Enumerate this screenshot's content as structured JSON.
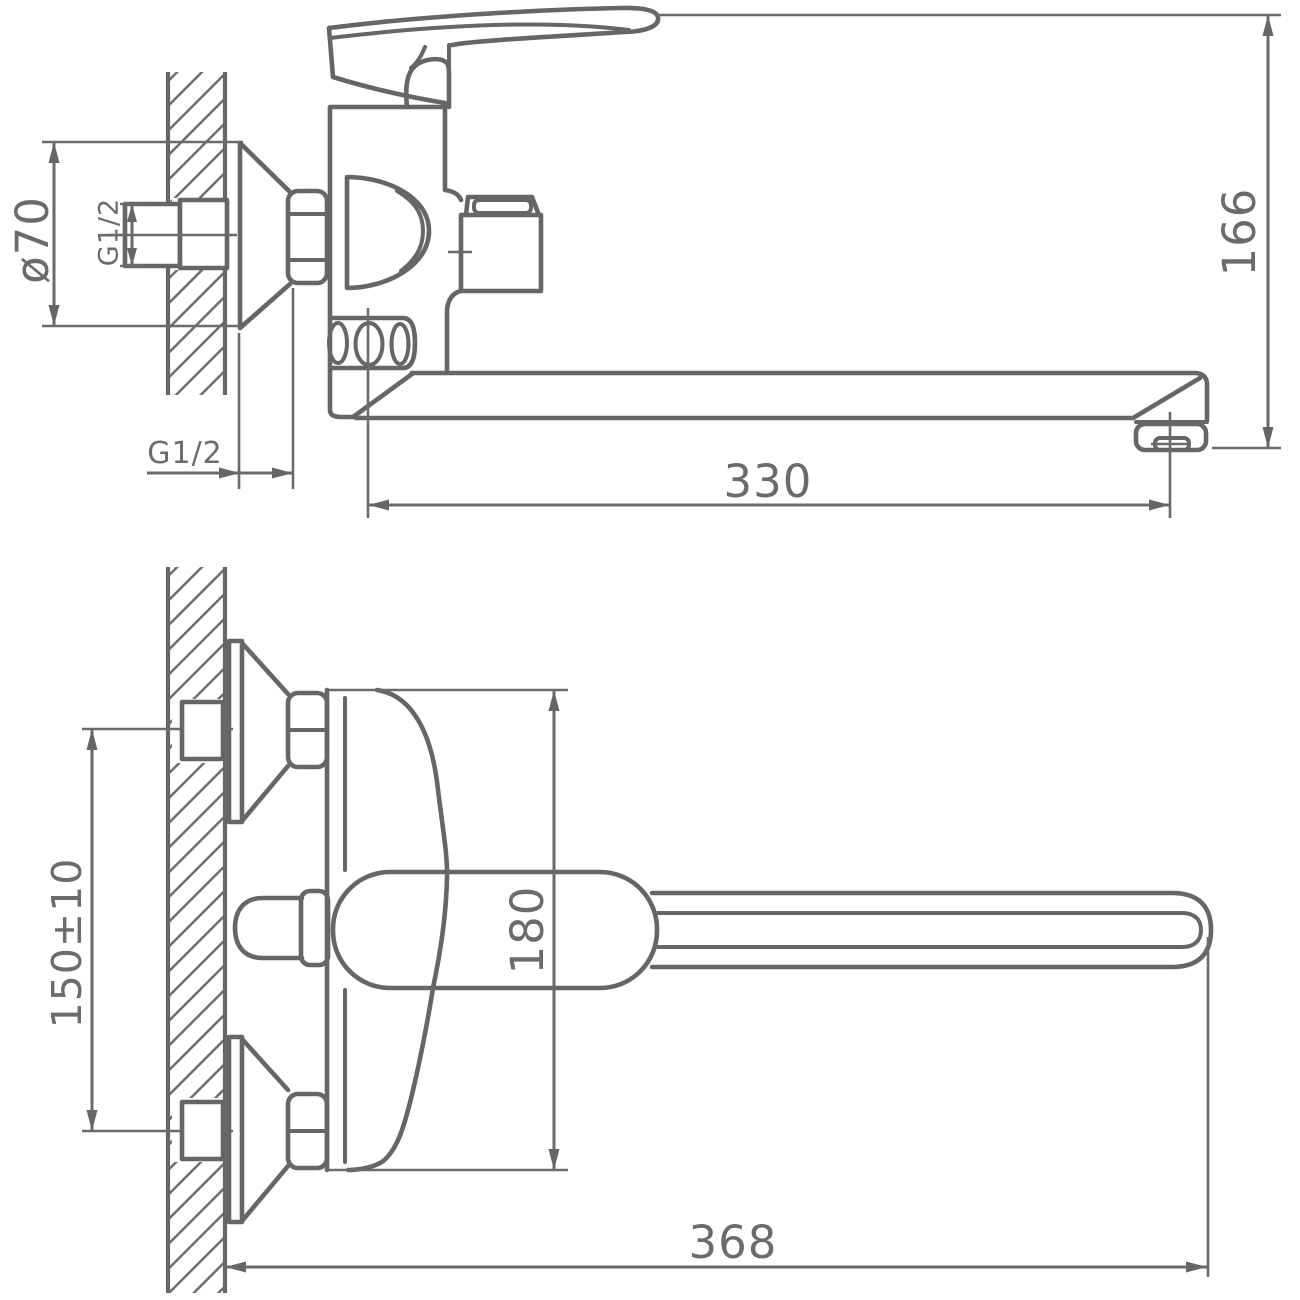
{
  "diagram": {
    "type": "technical-drawing",
    "subject": "Wall-mounted single-lever bath mixer faucet with long swivel spout, two orthographic views with dimensions",
    "background_color": "#ffffff",
    "line_color": "#666666",
    "text_color": "#6b6b6b",
    "units": "mm",
    "views": [
      {
        "id": "side-view",
        "name": "side elevation view"
      },
      {
        "id": "front-view",
        "name": "front / plan view"
      }
    ],
    "dimensions": {
      "flange_diameter": "ø70",
      "inlet_thread": "G1/2",
      "wall_connection_thread": "G1/2",
      "spout_reach": "330",
      "overall_height": "166",
      "supply_centers": "150±10",
      "body_height": "180",
      "overall_reach": "368"
    }
  }
}
